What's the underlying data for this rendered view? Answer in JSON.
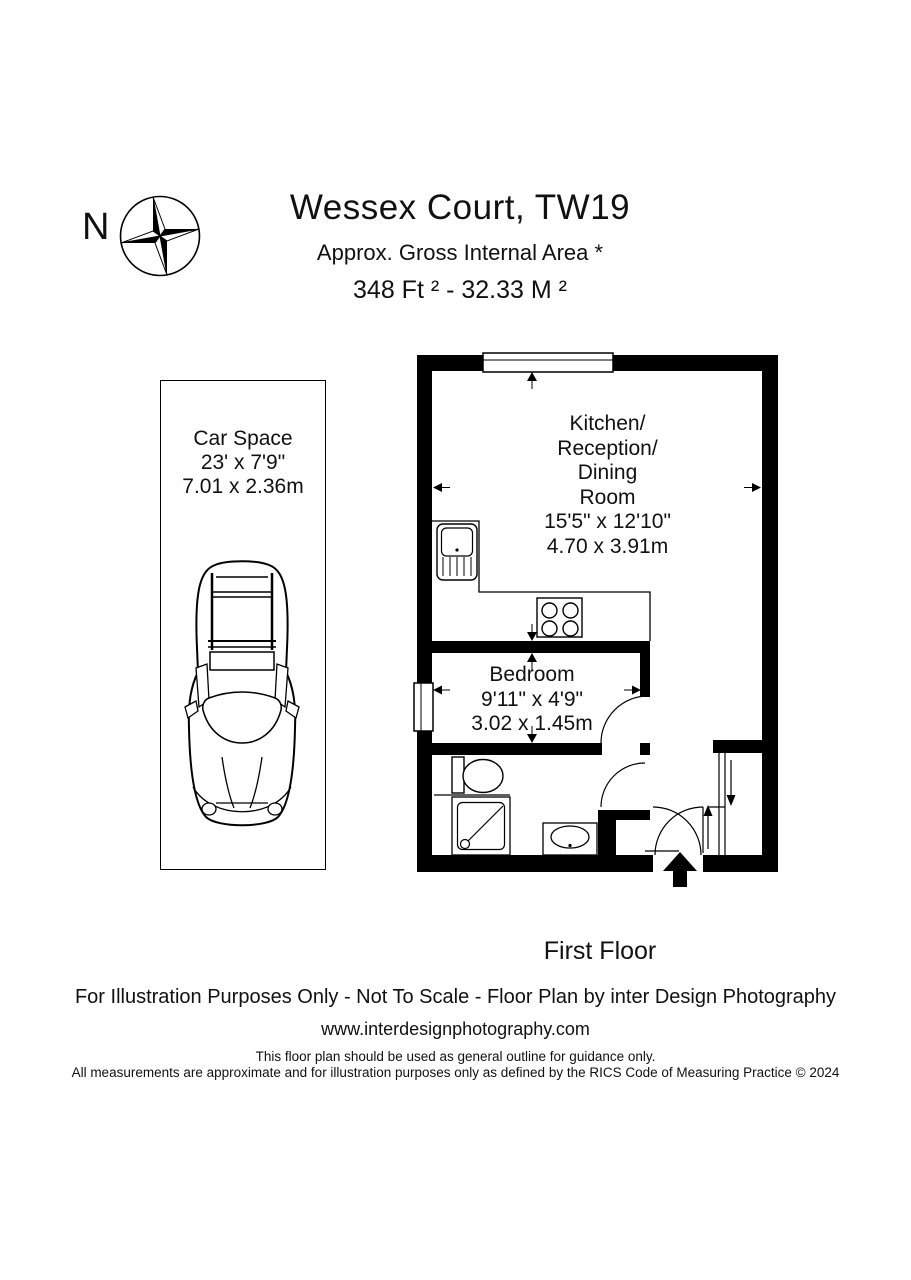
{
  "header": {
    "compass_label": "N",
    "title": "Wessex Court, TW19",
    "subtitle": "Approx. Gross Internal Area *",
    "area": "348 Ft ²  -  32.33 M ²"
  },
  "car_space": {
    "label": "Car Space\n23' x 7'9\"\n7.01 x 2.36m"
  },
  "floor_plan": {
    "rooms": [
      {
        "name": "kitchen-reception-dining",
        "label": "Kitchen/\nReception/\nDining\nRoom\n15'5\" x 12'10\"\n4.70 x 3.91m"
      },
      {
        "name": "bedroom",
        "label": "Bedroom\n9'11\" x 4'9\"\n3.02 x 1.45m"
      }
    ],
    "fixtures": [
      "sink-unit",
      "hob",
      "toilet",
      "shower",
      "basin",
      "stairs",
      "entrance-arrow",
      "windows",
      "door-swings"
    ],
    "floor_label": "First Floor",
    "colors": {
      "walls": "#000000",
      "background": "#ffffff",
      "lines": "#000000"
    }
  },
  "footer": {
    "line1": "For Illustration Purposes Only - Not To Scale - Floor Plan by inter Design Photography",
    "website": "www.interdesignphotography.com",
    "disclaimer": "This floor plan should be used as general outline for guidance only.\nAll measurements are approximate and for illustration purposes only as defined by the RICS Code of Measuring Practice © 2024"
  }
}
